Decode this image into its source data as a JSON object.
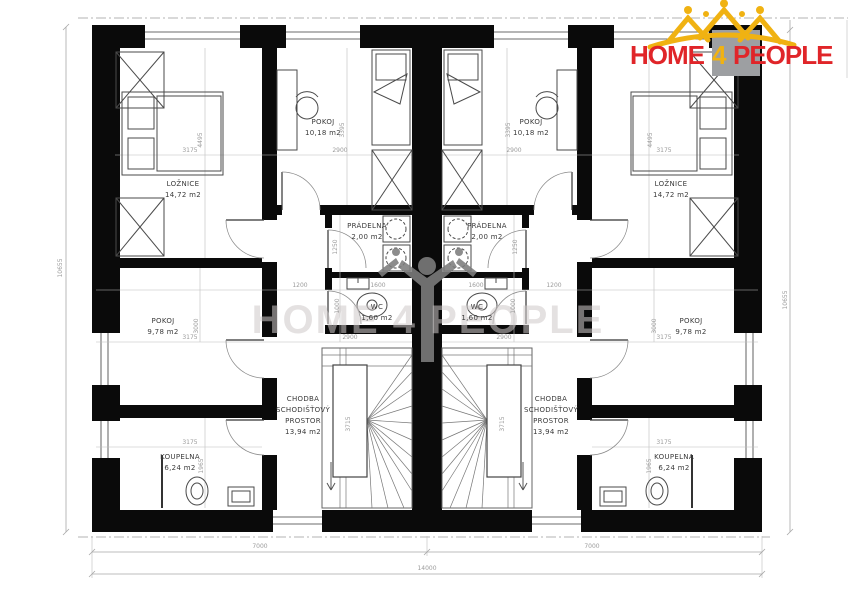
{
  "logo": {
    "home": "HOME",
    "four": "4",
    "people": "PEOPLE",
    "text_color": "#e02529",
    "accent_color": "#f0b212",
    "house_color": "#9d9fa2"
  },
  "watermark": {
    "text": "HOME 4 PEOPLE"
  },
  "floorplan": {
    "overall_width_mm": "14000",
    "overall_height_mm": "10655",
    "unit_width_mm": "7000",
    "room_labels": [
      {
        "x": 183,
        "y": 186,
        "lines": [
          "LOŽNICE",
          "14,72 m2"
        ]
      },
      {
        "x": 323,
        "y": 124,
        "lines": [
          "POKOJ",
          "10,18 m2"
        ]
      },
      {
        "x": 367,
        "y": 228,
        "lines": [
          "PRÁDELNA",
          "2,00 m2"
        ]
      },
      {
        "x": 377,
        "y": 309,
        "lines": [
          "WC",
          "1,60 m2"
        ]
      },
      {
        "x": 303,
        "y": 401,
        "lines": [
          "CHODBA",
          "SCHODIŠŤOVÝ",
          "PROSTOR",
          "13,94 m2"
        ]
      },
      {
        "x": 163,
        "y": 323,
        "lines": [
          "POKOJ",
          "9,78 m2"
        ]
      },
      {
        "x": 180,
        "y": 459,
        "lines": [
          "KOUPELNA",
          "6,24 m2"
        ]
      },
      {
        "x": 671,
        "y": 186,
        "lines": [
          "LOŽNICE",
          "14,72 m2"
        ]
      },
      {
        "x": 531,
        "y": 124,
        "lines": [
          "POKOJ",
          "10,18 m2"
        ]
      },
      {
        "x": 487,
        "y": 228,
        "lines": [
          "PRÁDELNA",
          "2,00 m2"
        ]
      },
      {
        "x": 477,
        "y": 309,
        "lines": [
          "WC",
          "1,60 m2"
        ]
      },
      {
        "x": 551,
        "y": 401,
        "lines": [
          "CHODBA",
          "SCHODIŠŤOVÝ",
          "PROSTOR",
          "13,94 m2"
        ]
      },
      {
        "x": 691,
        "y": 323,
        "lines": [
          "POKOJ",
          "9,78 m2"
        ]
      },
      {
        "x": 674,
        "y": 459,
        "lines": [
          "KOUPELNA",
          "6,24 m2"
        ]
      }
    ],
    "dimensions": [
      {
        "text": "10655",
        "x": 62,
        "y": 268,
        "rot": -90
      },
      {
        "text": "10655",
        "x": 787,
        "y": 300,
        "rot": -90
      },
      {
        "text": "7000",
        "x": 260,
        "y": 548
      },
      {
        "text": "7000",
        "x": 592,
        "y": 548
      },
      {
        "text": "14000",
        "x": 427,
        "y": 570
      },
      {
        "text": "3175",
        "x": 190,
        "y": 152
      },
      {
        "text": "2900",
        "x": 340,
        "y": 152
      },
      {
        "text": "4495",
        "x": 202,
        "y": 140,
        "rot": -90
      },
      {
        "text": "3395",
        "x": 344,
        "y": 130,
        "rot": -90
      },
      {
        "text": "1250",
        "x": 337,
        "y": 247,
        "rot": -90
      },
      {
        "text": "1200",
        "x": 300,
        "y": 287
      },
      {
        "text": "1600",
        "x": 378,
        "y": 287
      },
      {
        "text": "1000",
        "x": 339,
        "y": 306,
        "rot": -90
      },
      {
        "text": "3175",
        "x": 190,
        "y": 339
      },
      {
        "text": "3000",
        "x": 198,
        "y": 326,
        "rot": -90
      },
      {
        "text": "2900",
        "x": 350,
        "y": 339
      },
      {
        "text": "3715",
        "x": 350,
        "y": 424,
        "rot": -90
      },
      {
        "text": "3175",
        "x": 190,
        "y": 444
      },
      {
        "text": "1965",
        "x": 203,
        "y": 466,
        "rot": -90
      },
      {
        "text": "3175",
        "x": 664,
        "y": 152
      },
      {
        "text": "2900",
        "x": 514,
        "y": 152
      },
      {
        "text": "4495",
        "x": 652,
        "y": 140,
        "rot": -90
      },
      {
        "text": "3395",
        "x": 510,
        "y": 130,
        "rot": -90
      },
      {
        "text": "1250",
        "x": 517,
        "y": 247,
        "rot": -90
      },
      {
        "text": "1200",
        "x": 554,
        "y": 287
      },
      {
        "text": "1600",
        "x": 476,
        "y": 287
      },
      {
        "text": "1000",
        "x": 515,
        "y": 306,
        "rot": -90
      },
      {
        "text": "3175",
        "x": 664,
        "y": 339
      },
      {
        "text": "3000",
        "x": 656,
        "y": 326,
        "rot": -90
      },
      {
        "text": "2900",
        "x": 504,
        "y": 339
      },
      {
        "text": "3715",
        "x": 504,
        "y": 424,
        "rot": -90
      },
      {
        "text": "3175",
        "x": 664,
        "y": 444
      },
      {
        "text": "1965",
        "x": 651,
        "y": 466,
        "rot": -90
      }
    ]
  }
}
